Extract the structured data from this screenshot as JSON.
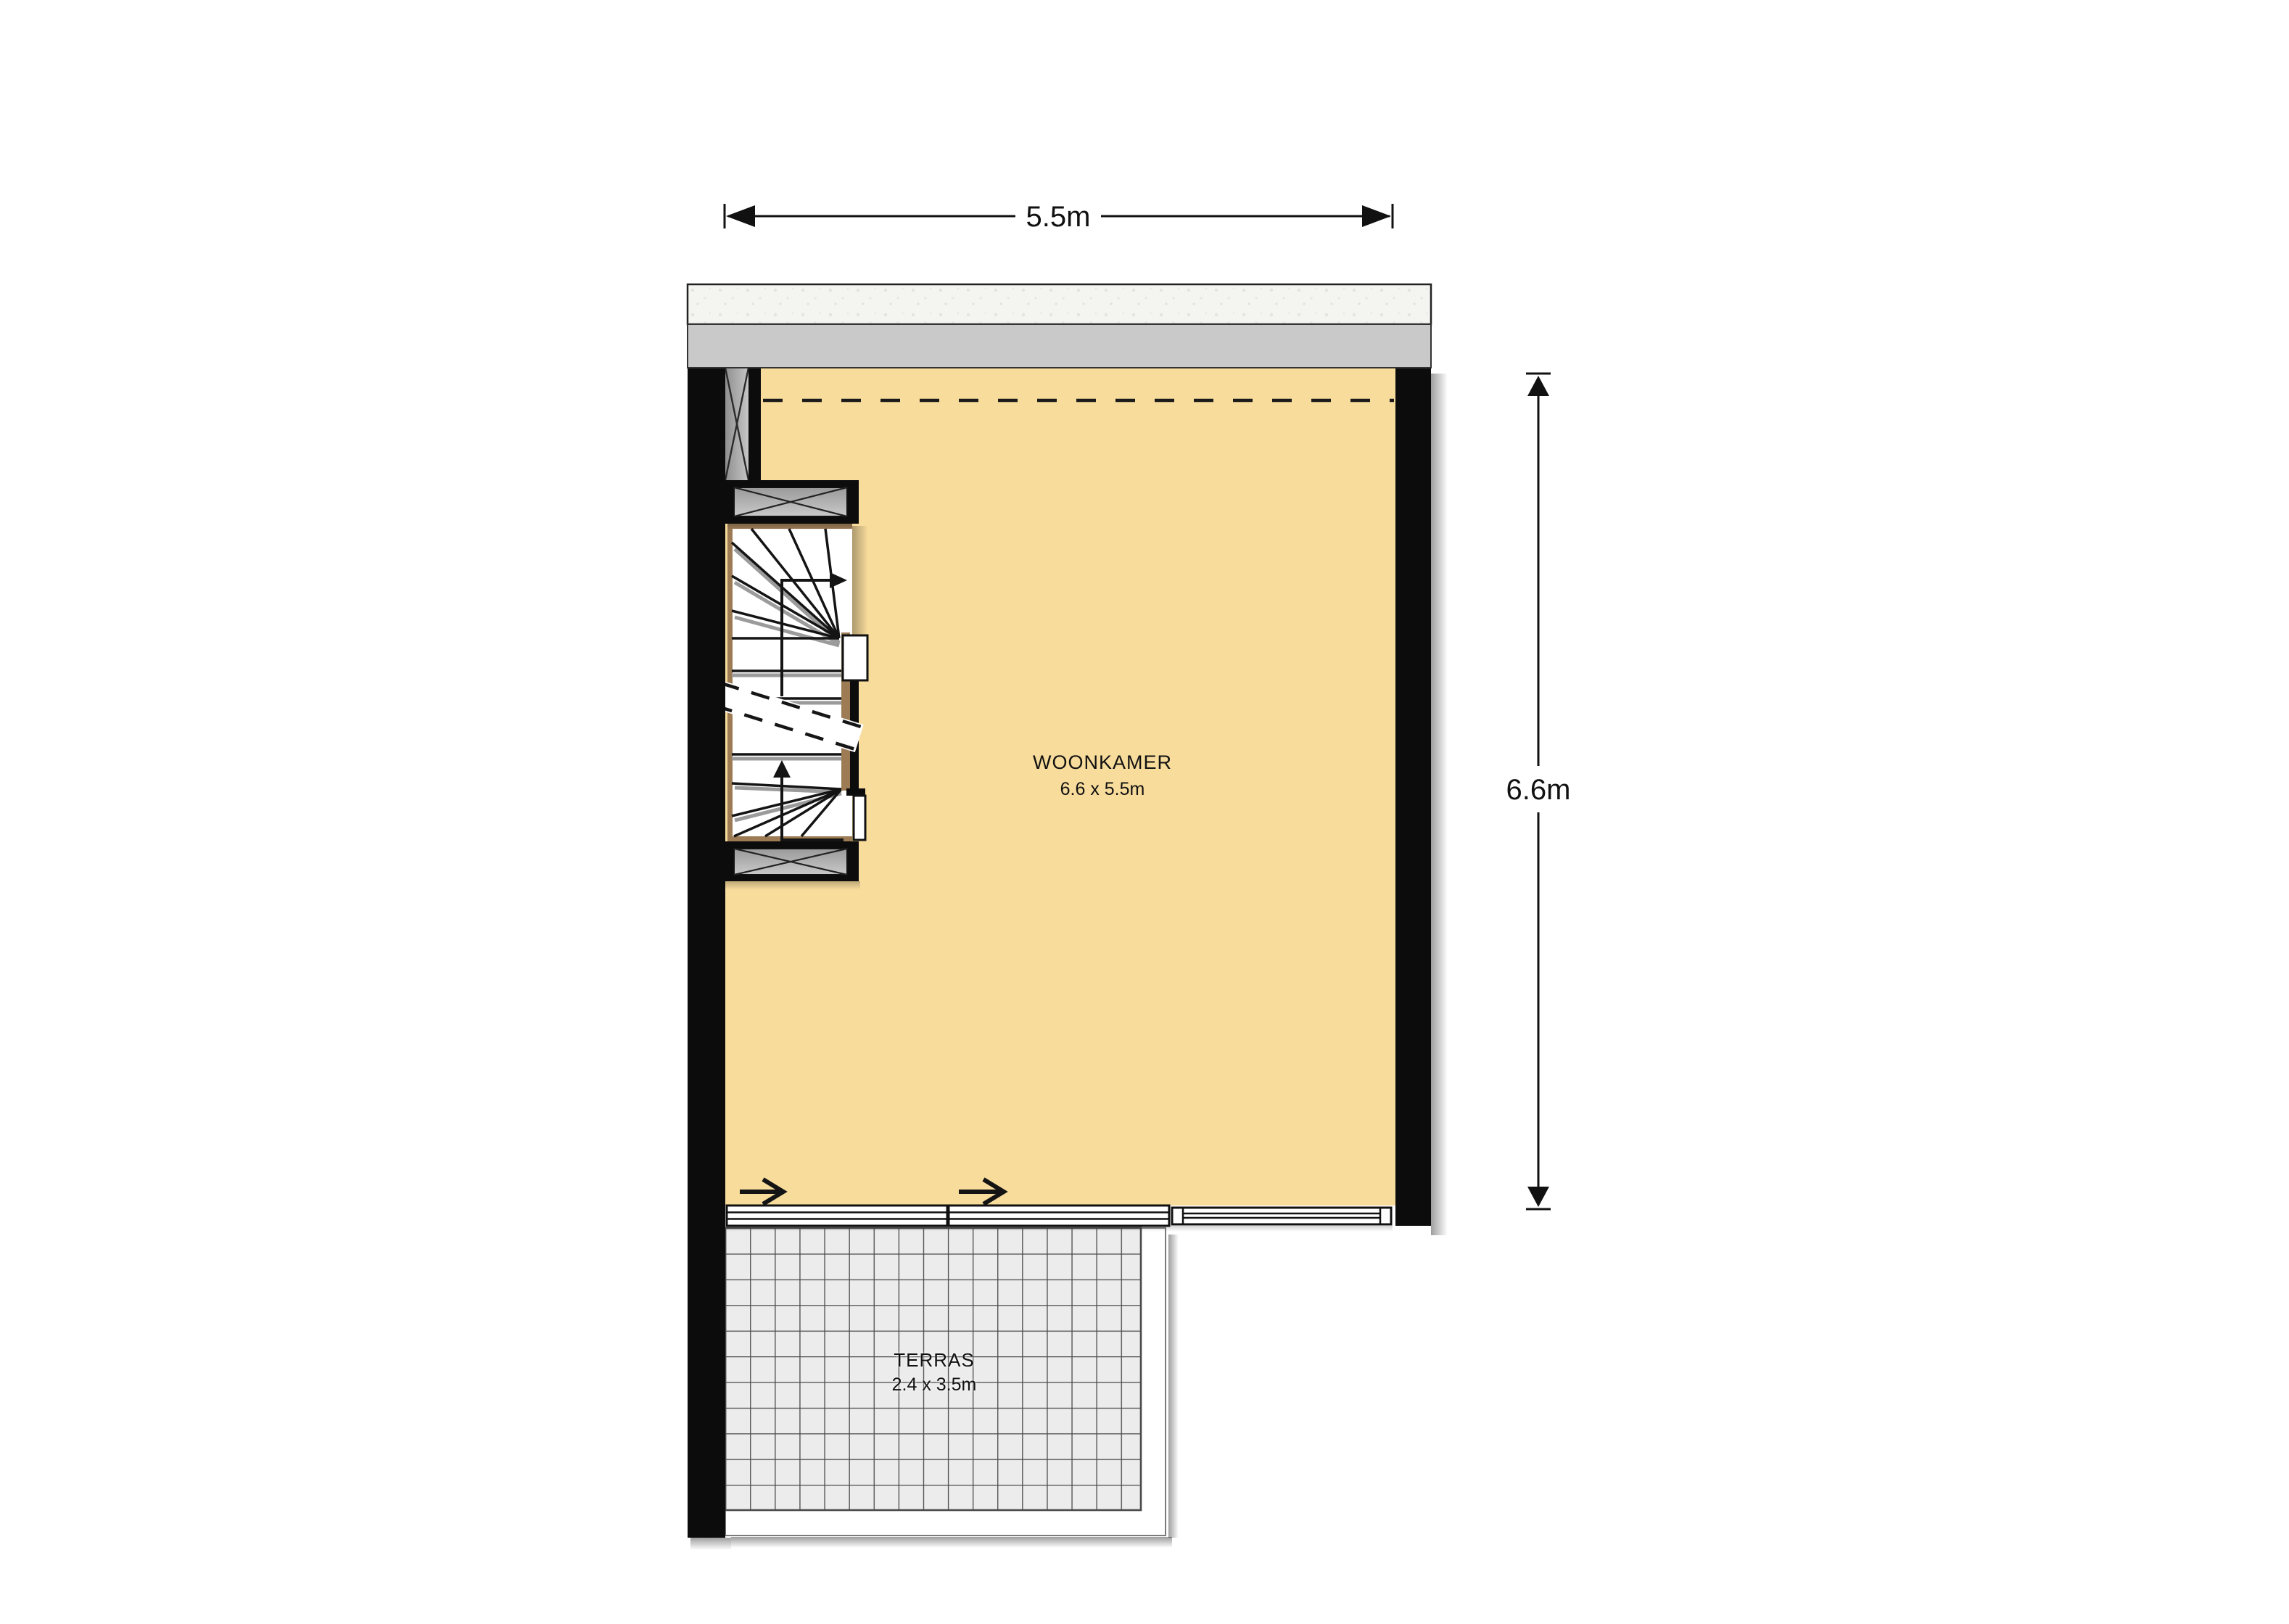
{
  "page": {
    "type": "floor plan drawing",
    "background": "#ffffff"
  },
  "rooms": [
    {
      "id": "woonkamer",
      "label": "WOONKAMER",
      "size": "6.6 x 5.5m"
    },
    {
      "id": "terras",
      "label": "TERRAS",
      "size": "2.4 x 3.5m"
    }
  ],
  "dimensions": {
    "width_label": "5.5m",
    "height_label": "6.6m"
  },
  "icons": {
    "dimension_arrow": "filled-triangle-with-end-tick",
    "door_slide_arrow": "right-line-arrow",
    "stair_direction_arrow": "line-arrow-with-solid-head"
  },
  "colors": {
    "room_fill": "#F8DC9C",
    "wall": "#0C0C0C",
    "facade_band": "#C9C9C9",
    "plaster_band": "#F4F4F1",
    "tile_fill": "#ECECEC",
    "tile_grout": "#4A4A4A",
    "stair_stringer": "#9C7B55",
    "hatch_fill": "#A9A9A9",
    "tread_shadow": "#9B9B9B"
  }
}
